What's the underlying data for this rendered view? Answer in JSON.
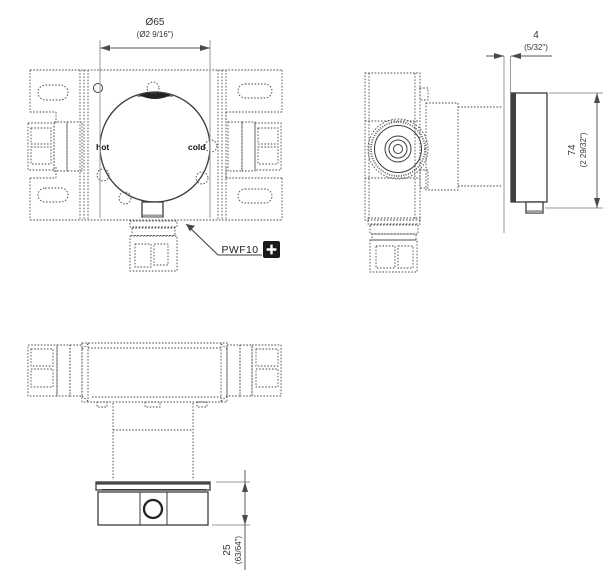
{
  "drawing": {
    "product_code": "PWF10",
    "labels": {
      "hot": "hot",
      "cold": "cold"
    },
    "dimensions": {
      "diameter": {
        "metric": "Ø65",
        "imperial": "(Ø2 9/16\")"
      },
      "plate_thickness": {
        "metric": "4",
        "imperial": "(5/32\")"
      },
      "height": {
        "metric": "74",
        "imperial": "(2 29/32\")"
      },
      "depth": {
        "metric": "25",
        "imperial": "(63/64\")"
      }
    },
    "colors": {
      "line": "#3b3b3b",
      "hidden_line": "#4a4a4a",
      "extension_line": "#9a9a9a",
      "badge_background": "#1a1a1a",
      "badge_glyph": "#ffffff"
    },
    "icons": {
      "badge": "plus-icon"
    }
  }
}
